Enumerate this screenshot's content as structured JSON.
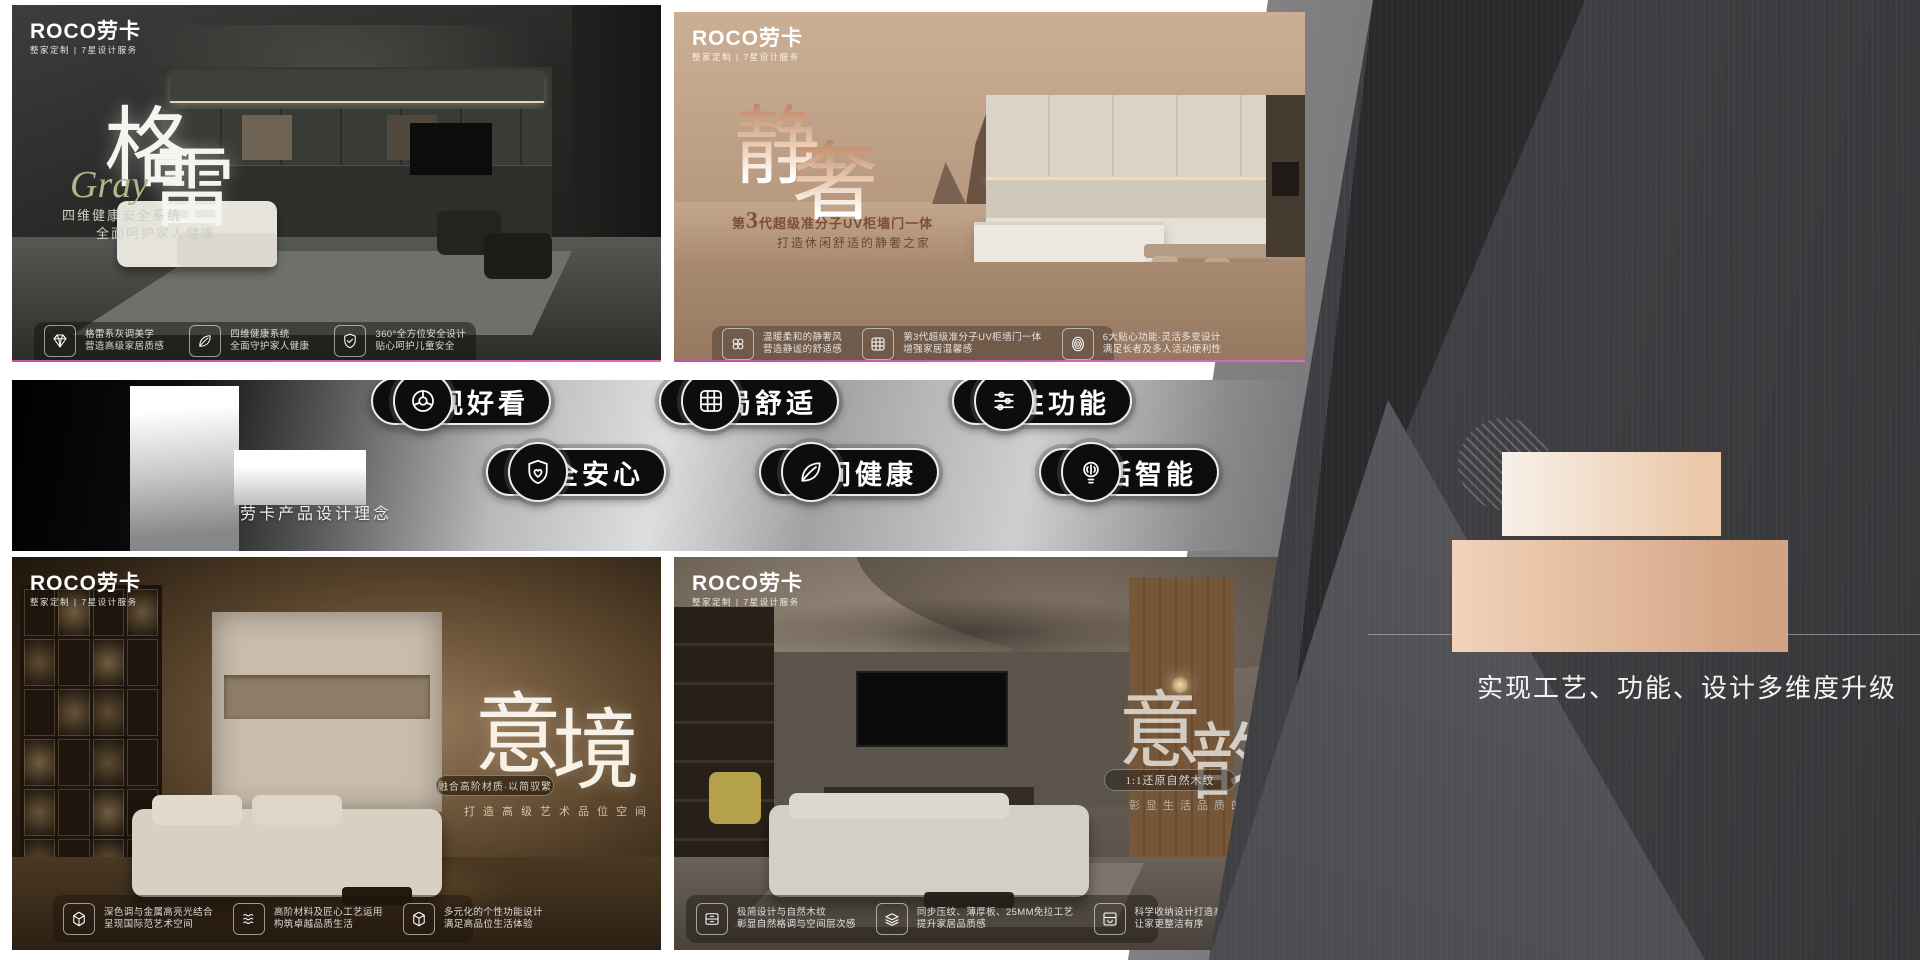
{
  "brand": {
    "logo": "ROCO劳卡",
    "tagline": "整家定制 | 7星设计服务"
  },
  "poster_gray": {
    "title_char1": "格",
    "title_char2": "雷",
    "title_script": "Gray",
    "subtitle1": "四维健康安全系统",
    "subtitle2": "全面呵护家人健康",
    "features": [
      {
        "icon": "diamond-icon",
        "line1": "格雷系灰调美学",
        "line2": "营造高级家居质感"
      },
      {
        "icon": "leaf-icon",
        "line1": "四维健康系统",
        "line2": "全面守护家人健康"
      },
      {
        "icon": "shield-check-icon",
        "line1": "360°全方位安全设计",
        "line2": "贴心呵护儿童安全"
      }
    ]
  },
  "poster_jingshe": {
    "title_char1": "静",
    "title_char2": "奢",
    "subtitle_prefix": "第",
    "subtitle_num": "3",
    "subtitle_rest": "代超级准分子UV柜墙门一体",
    "subtitle2": "打造休闲舒适的静奢之家",
    "features": [
      {
        "icon": "clover-icon",
        "line1": "温暖柔和的静奢风",
        "line2": "营造静谧的舒适感"
      },
      {
        "icon": "cabinet-grid-icon",
        "line1": "第3代超级准分子UV柜墙门一体",
        "line2": "增强家居温馨感"
      },
      {
        "icon": "fingerprint-icon",
        "line1": "6大贴心功能·灵活多变设计",
        "line2": "满足长者及多人活动便利性"
      }
    ]
  },
  "standards": {
    "number": "6",
    "heading": "大标准",
    "caption": "劳卡产品设计理念",
    "badges": [
      {
        "icon": "aperture-icon",
        "label": "外观好看"
      },
      {
        "icon": "grid-icon",
        "label": "布局舒适"
      },
      {
        "icon": "sliders-icon",
        "label": "个性功能"
      },
      {
        "icon": "shield-heart-icon",
        "label": "安全安心"
      },
      {
        "icon": "leaf-icon",
        "label": "空间健康"
      },
      {
        "icon": "smart-bulb-icon",
        "label": "生活智能"
      }
    ]
  },
  "poster_yijing": {
    "title_char1": "意",
    "title_char2": "境",
    "badge": "融合高阶材质·以简驭繁",
    "subtitle": "打造高级艺术品位空间",
    "features": [
      {
        "icon": "gem-icon",
        "line1": "深色调与金属高亮光结合",
        "line2": "呈现国际范艺术空间"
      },
      {
        "icon": "waves-icon",
        "line1": "高阶材料及匠心工艺运用",
        "line2": "构筑卓越品质生活"
      },
      {
        "icon": "cube-icon",
        "line1": "多元化的个性功能设计",
        "line2": "满足高品位生活体验"
      }
    ]
  },
  "poster_yiyun": {
    "title_char1": "意",
    "title_char2": "韵",
    "badge": "1:1还原自然木纹",
    "subtitle": "彰显生活品质的意式",
    "features": [
      {
        "icon": "drawer-icon",
        "line1": "极简设计与自然木纹",
        "line2": "彰显自然格调与空间层次感"
      },
      {
        "icon": "layers-icon",
        "line1": "同步压纹、薄厚板、25MM免拉工艺",
        "line2": "提升家居品质感"
      },
      {
        "icon": "storage-icon",
        "line1": "科学收纳设计打造高效收纳空间",
        "line2": "让家更整洁有序"
      }
    ]
  },
  "right_panel": {
    "headline1": "4大系列",
    "headline2": "新品上市",
    "caption": "实现工艺、功能、设计多维度升级"
  },
  "colors": {
    "accent_tan": "#d9b296",
    "magenta_accent": "#d24fb4",
    "badge_black": "#0d0d0d",
    "panel_dark": "#3a3a3d"
  }
}
